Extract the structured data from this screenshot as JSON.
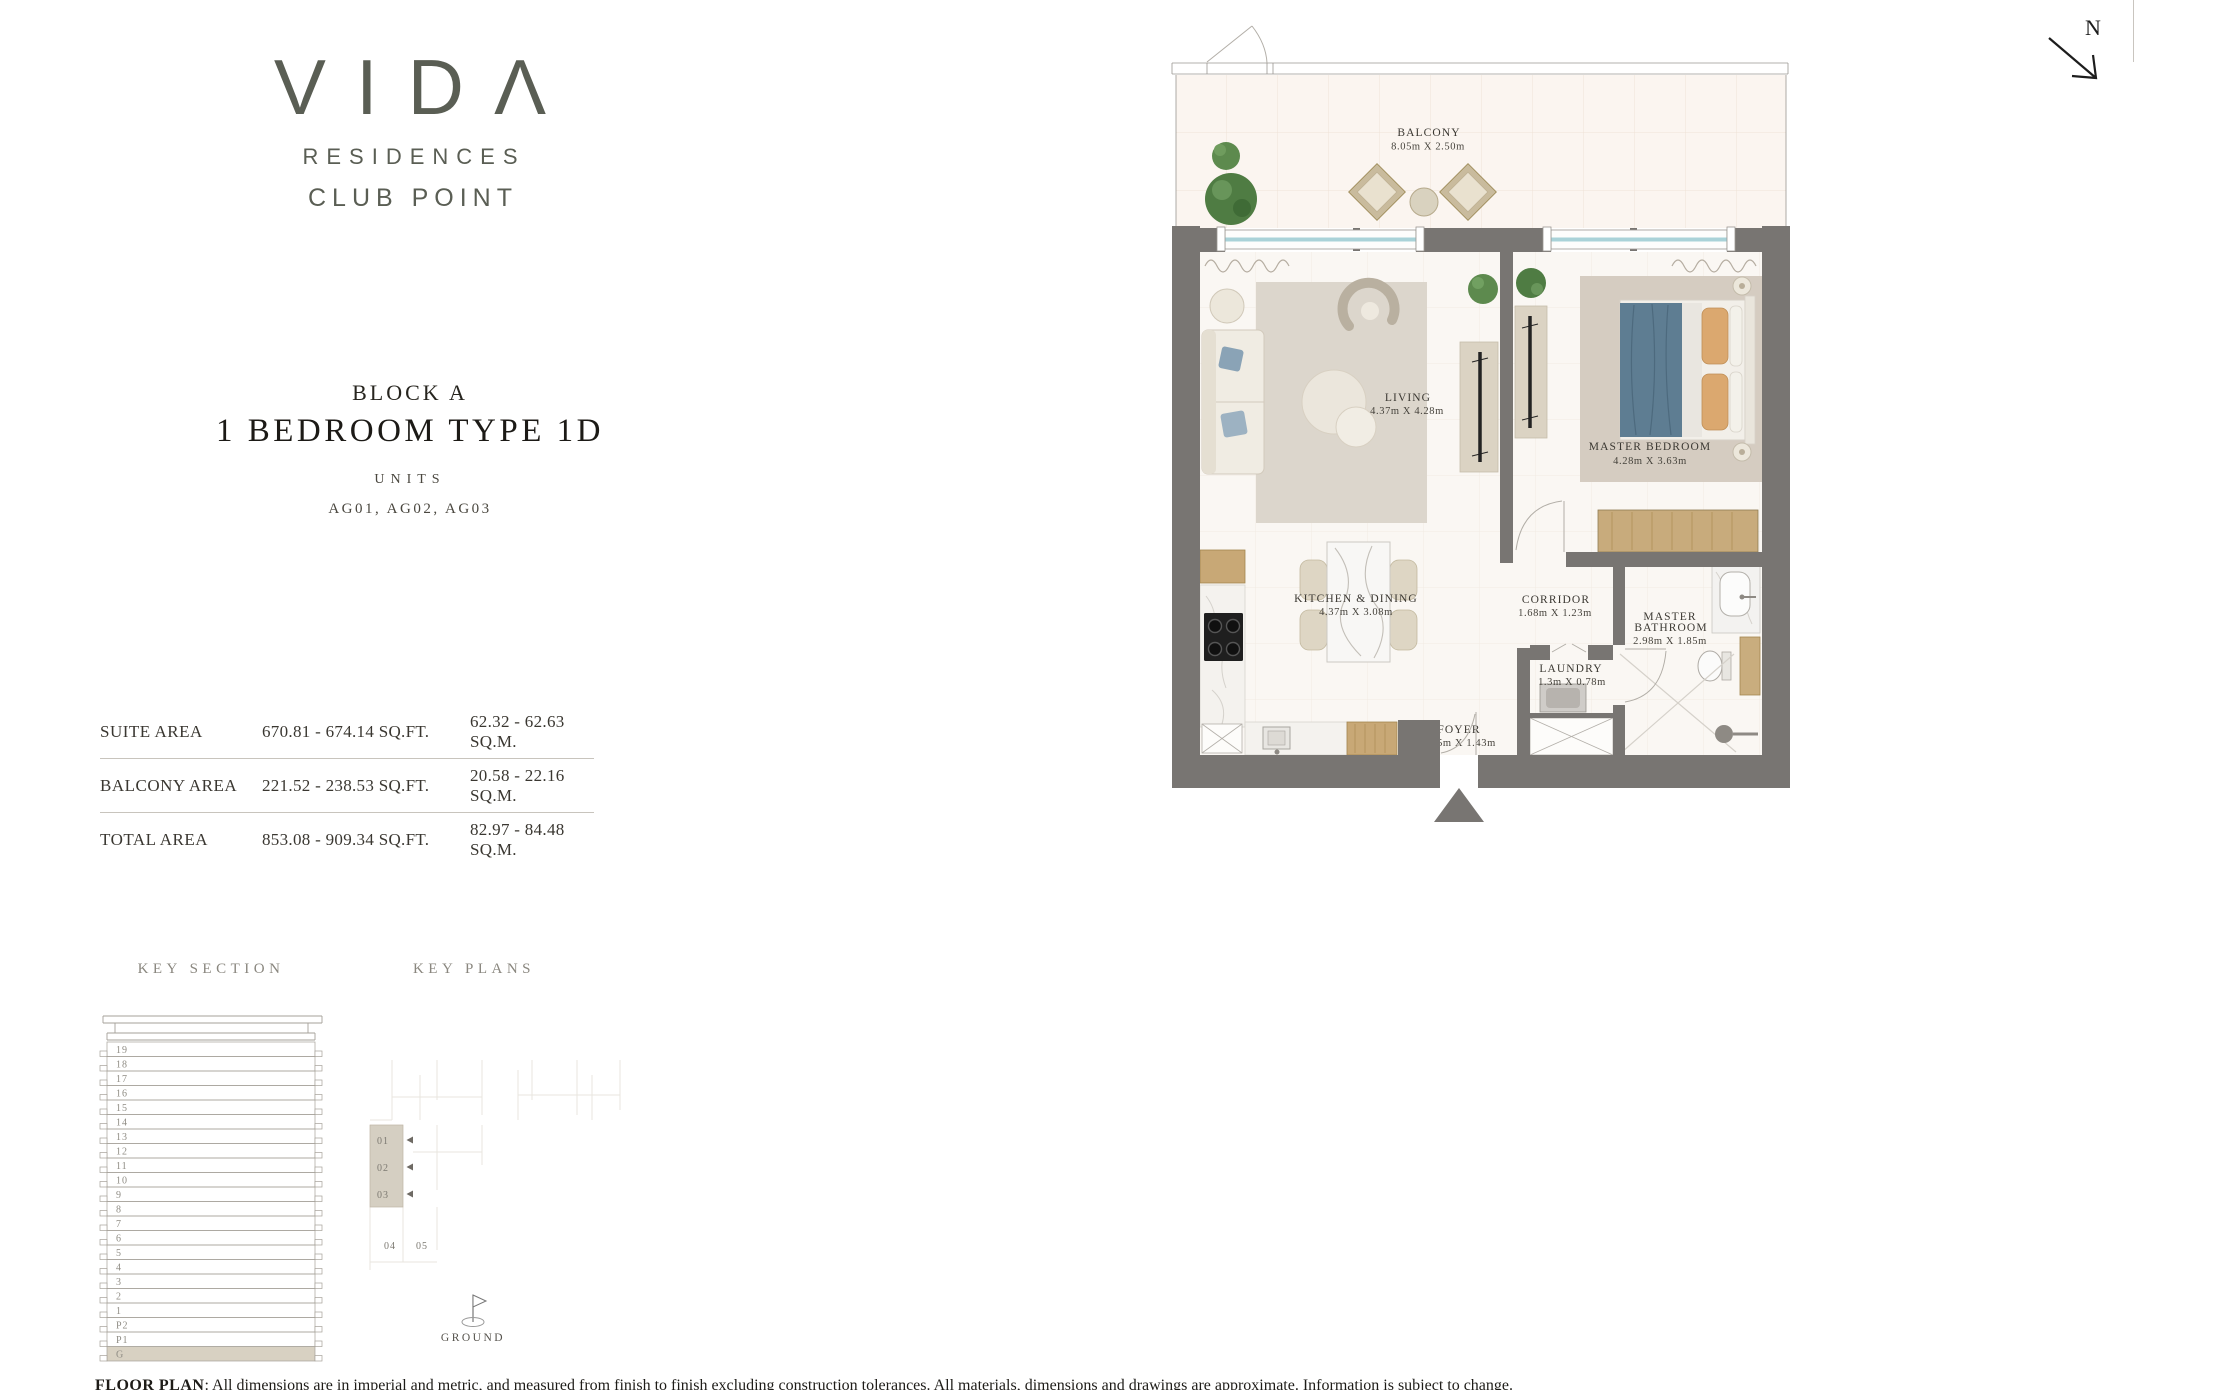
{
  "brand": {
    "logo": "VIDΛ",
    "line1": "RESIDENCES",
    "line2": "CLUB POINT"
  },
  "header": {
    "block": "BLOCK A",
    "title": "1 BEDROOM TYPE 1D",
    "units_label": "UNITS",
    "units": "AG01, AG02, AG03"
  },
  "area_table": {
    "rows": [
      {
        "label": "SUITE AREA",
        "sqft": "670.81 - 674.14 SQ.FT.",
        "sqm": "62.32 - 62.63 SQ.M."
      },
      {
        "label": "BALCONY AREA",
        "sqft": "221.52 - 238.53 SQ.FT.",
        "sqm": "20.58 - 22.16 SQ.M."
      },
      {
        "label": "TOTAL AREA",
        "sqft": "853.08 - 909.34 SQ.FT.",
        "sqm": "82.97 - 84.48 SQ.M."
      }
    ]
  },
  "key_section": {
    "heading": "KEY SECTION",
    "floors": [
      "19",
      "18",
      "17",
      "16",
      "15",
      "14",
      "13",
      "12",
      "11",
      "10",
      "9",
      "8",
      "7",
      "6",
      "5",
      "4",
      "3",
      "2",
      "1",
      "P2",
      "P1",
      "G"
    ],
    "highlight_floor": "G"
  },
  "key_plans": {
    "heading": "KEY PLANS",
    "highlighted_units": [
      "01",
      "02",
      "03"
    ],
    "other_units": [
      "04",
      "05"
    ],
    "level_label": "GROUND"
  },
  "floor_plan": {
    "north_label": "N",
    "rooms": [
      {
        "id": "balcony",
        "lines": [
          "BALCONY"
        ],
        "dims": "8.05m X 2.50m"
      },
      {
        "id": "living",
        "lines": [
          "LIVING"
        ],
        "dims": "4.37m X 4.28m"
      },
      {
        "id": "master-bedroom",
        "lines": [
          "MASTER BEDROOM"
        ],
        "dims": "4.28m X 3.63m"
      },
      {
        "id": "kitchen-dining",
        "lines": [
          "KITCHEN & DINING"
        ],
        "dims": "4.37m X 3.08m"
      },
      {
        "id": "corridor",
        "lines": [
          "CORRIDOR"
        ],
        "dims": "1.68m X 1.23m"
      },
      {
        "id": "master-bathroom",
        "lines": [
          "MASTER",
          "BATHROOM"
        ],
        "dims": "2.98m X 1.85m"
      },
      {
        "id": "laundry",
        "lines": [
          "LAUNDRY"
        ],
        "dims": "1.3m X 0.78m"
      },
      {
        "id": "foyer",
        "lines": [
          "FOYER"
        ],
        "dims": "1.75m X 1.43m"
      }
    ]
  },
  "disclaimer": {
    "prefix": "FLOOR PLAN",
    "body": ": All dimensions are in imperial and metric, and measured from finish to finish excluding construction tolerances. All materials, dimensions and drawings are approximate. Information is subject to change."
  }
}
